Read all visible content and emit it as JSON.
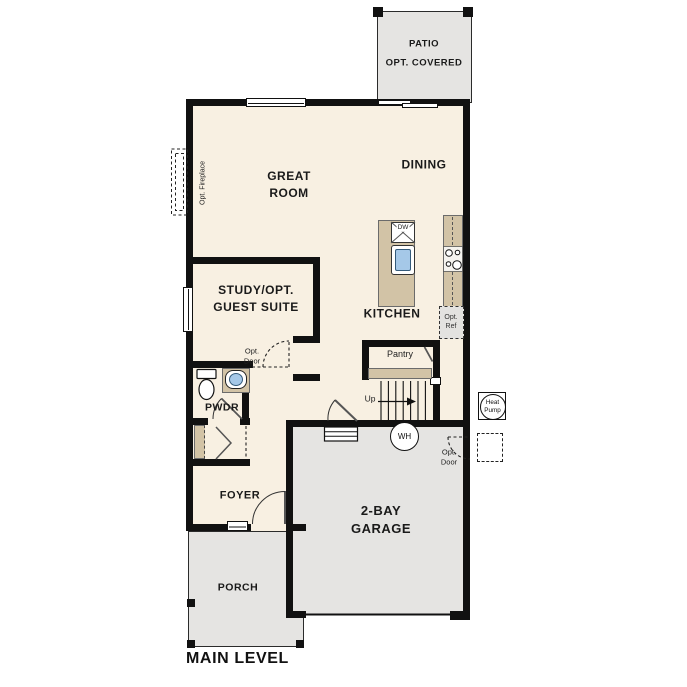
{
  "plan": {
    "title": "MAIN LEVEL"
  },
  "rooms": {
    "patio": {
      "name": "PATIO",
      "note": "OPT. COVERED"
    },
    "great_room": {
      "line1": "GREAT",
      "line2": "ROOM"
    },
    "dining": {
      "name": "DINING"
    },
    "study": {
      "line1": "STUDY/OPT.",
      "line2": "GUEST SUITE"
    },
    "kitchen": {
      "name": "KITCHEN"
    },
    "pantry": {
      "name": "Pantry"
    },
    "powder_room": {
      "name": "PWDR"
    },
    "foyer": {
      "name": "FOYER"
    },
    "porch": {
      "name": "PORCH"
    },
    "garage": {
      "line1": "2-BAY",
      "line2": "GARAGE"
    }
  },
  "annotations": {
    "opt_fireplace": "Opt. Fireplace",
    "opt_door_study": {
      "line1": "Opt.",
      "line2": "Door"
    },
    "opt_door_garage": {
      "line1": "Opt.",
      "line2": "Door"
    },
    "opt_ref": {
      "line1": "Opt.",
      "line2": "Ref"
    },
    "dishwasher": "DW",
    "water_heater": "WH",
    "heat_pump": {
      "line1": "Heat",
      "line2": "Pump"
    },
    "stairs": "Up"
  },
  "colors": {
    "wall": "#111111",
    "interior_floor": "#f8f0e2",
    "exterior_concrete": "#e5e4e2",
    "counter": "#d2c3a6",
    "sink_fixture": "#a5c8e8",
    "background": "#ffffff"
  }
}
